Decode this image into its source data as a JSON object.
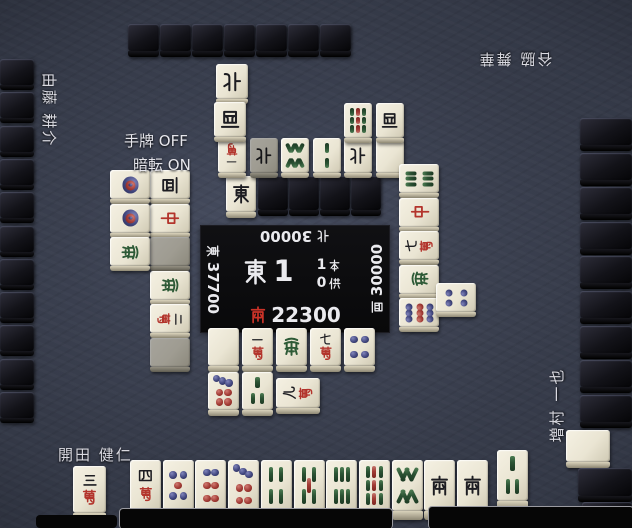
{
  "window": {
    "width": 632,
    "height": 528
  },
  "options": {
    "tehai_label": "手牌",
    "tehai_value": "OFF",
    "anten_label": "暗転",
    "anten_value": "ON"
  },
  "center_panel": {
    "round_wind": "東",
    "round_number": "1",
    "honba": {
      "count": "1",
      "unit": "本"
    },
    "kyotaku": {
      "count": "0",
      "unit": "供"
    },
    "scores": {
      "east": {
        "wind": "東",
        "value": "37700"
      },
      "south": {
        "wind": "南",
        "value": "22300"
      },
      "west": {
        "wind": "西",
        "value": "30000"
      },
      "north": {
        "wind": "北",
        "value": "30000"
      }
    }
  },
  "dora_indicator": "east",
  "players": {
    "bottom": {
      "name": "開田 健仁",
      "hand": [
        "4m",
        "5p",
        "6p",
        "7p",
        "4s",
        "5s",
        "6s",
        "9s",
        "8s",
        "south",
        "south"
      ],
      "drawn_tile": "3s",
      "separated_tile": "3m",
      "discards": {
        "row1": [
          "haku",
          "1m",
          "hatsu",
          "7m",
          "4p"
        ],
        "row2": [
          "7p",
          "3s"
        ],
        "riichi_tile": "9m"
      }
    },
    "left": {
      "name": "由藤 耕介",
      "discards": {
        "row1": [
          "west",
          "chun",
          "haku!",
          "hatsu",
          "2m",
          "haku!"
        ],
        "row2": [
          "1p",
          "1p",
          "hatsu"
        ]
      }
    },
    "top": {
      "name": "谷脇 舞華",
      "discards": {
        "row1": [
          "1m",
          "north!",
          "8s",
          "2s",
          "north",
          "haku"
        ],
        "row2": [
          "9s",
          "west"
        ],
        "extra": [
          "north",
          "west"
        ]
      }
    },
    "right": {
      "name": "増村 一也",
      "discards": {
        "col1": [
          "6s",
          "chun",
          "7m",
          "hatsu",
          "9p"
        ],
        "col2": [
          "4p"
        ]
      }
    }
  },
  "walls": {
    "top_count": 7,
    "left_count": 11,
    "right_count": 9,
    "dead_wall_backs": 4,
    "right_extra_backs": 2,
    "right_face_up_blank": true
  },
  "colors": {
    "felt": "#3c4150",
    "tile_face": "#ece7d7",
    "tile_back": "#121218",
    "accent_red": "#b3342c",
    "green": "#2d5a36",
    "blue_circle": "#42477f",
    "panel": "#0c0c0e",
    "text": "#e8e8ec",
    "score_south_red": "#cc3328"
  }
}
